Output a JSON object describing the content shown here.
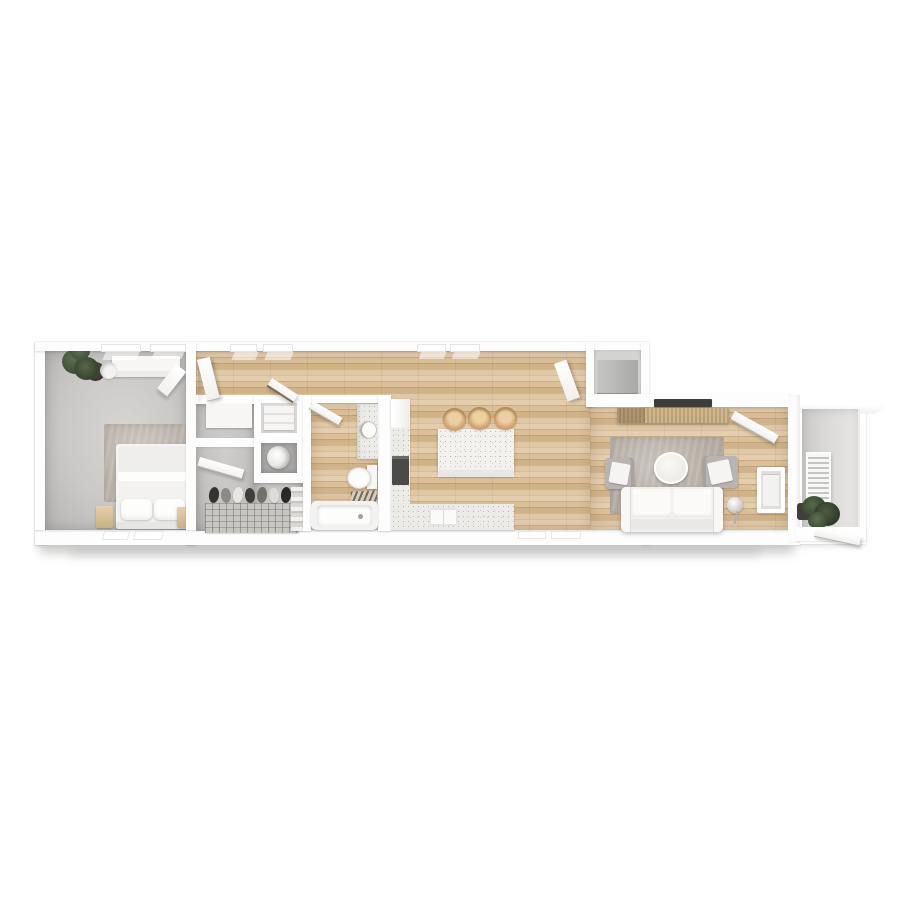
{
  "scene": {
    "title": "3D rendered apartment floor plan, top-down view",
    "background": "#ffffff"
  },
  "palette": {
    "wall": "#ffffff",
    "wood_floor": "#dcc098",
    "wood_plank_light": "#ecd9b8",
    "carpet_gray": "#cac8c6",
    "area_rug": "#b2aaa0",
    "balcony_concrete": "#dbdad8",
    "stool_tan": "#d3a671",
    "console_rattan": "#c3aa80",
    "plant_green": "#46543c",
    "appliance_gray": "#b5b6b4",
    "tv_dark": "#3d3d3c",
    "oven_dark": "#4b4a48",
    "drop_shadow": "#c6c4c2"
  },
  "rooms": {
    "bedroom": {
      "label": "bedroom",
      "furniture": [
        "bed",
        "pillows",
        "rug",
        "nightstand-left",
        "nightstand-right",
        "dresser",
        "potted-plant",
        "open-door"
      ],
      "window_count": 4
    },
    "closet": {
      "label": "walk-in closet",
      "furniture": [
        "linen-cabinet",
        "wire-shoe-rack",
        "shoes",
        "folded-clothes",
        "utility-cabinet",
        "water-heater",
        "open-door"
      ],
      "shoe_count": 7
    },
    "bathroom": {
      "label": "bathroom",
      "furniture": [
        "vanity-sink",
        "toilet",
        "bath-mat",
        "bathtub",
        "open-door"
      ]
    },
    "kitchen": {
      "label": "kitchen",
      "furniture": [
        "refrigerator",
        "counter",
        "oven",
        "sink",
        "island",
        "bar-stools"
      ],
      "stool_count": 3,
      "window_count": 2
    },
    "laundry": {
      "label": "laundry closet",
      "furniture": [
        "stacked-washer-dryer",
        "open-door"
      ]
    },
    "living": {
      "label": "living room",
      "furniture": [
        "tv",
        "media-console",
        "area-rug",
        "coffee-table",
        "armchair-left",
        "armchair-right",
        "sofa",
        "floor-lamp",
        "wall-window",
        "entry-door"
      ]
    },
    "balcony": {
      "label": "balcony",
      "furniture": [
        "ac-louver-unit",
        "potted-plant",
        "gate-door",
        "roof-overhang"
      ]
    }
  }
}
